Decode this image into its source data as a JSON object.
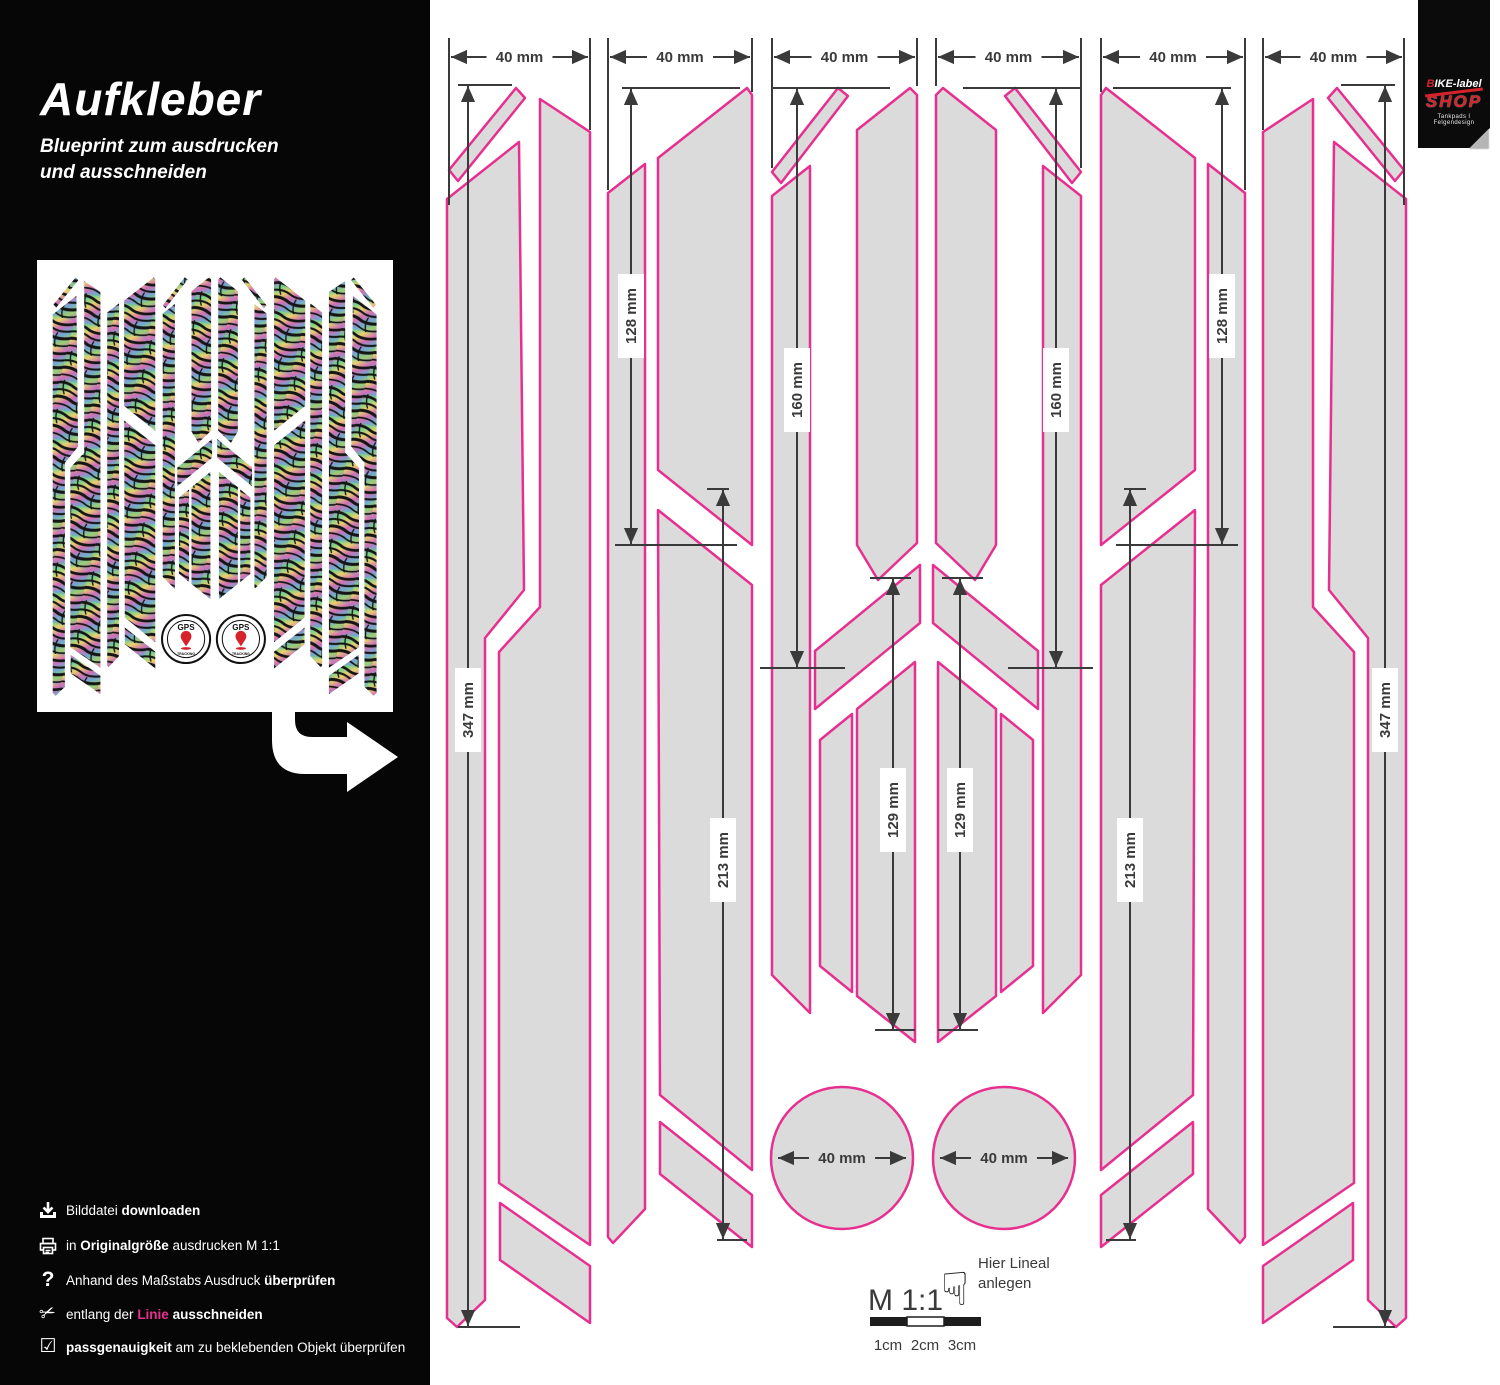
{
  "sidebar": {
    "title": "Aufkleber",
    "subtitle_line1": "Blueprint zum ausdrucken",
    "subtitle_line2": "und ausschneiden",
    "instructions": [
      {
        "icon": "download-icon",
        "parts": [
          {
            "t": "Bilddatei "
          },
          {
            "t": "downloaden",
            "b": true
          }
        ]
      },
      {
        "icon": "printer-icon",
        "parts": [
          {
            "t": "in "
          },
          {
            "t": "Originalgröße",
            "b": true
          },
          {
            "t": " ausdrucken M 1:1"
          }
        ]
      },
      {
        "icon": "question-icon",
        "parts": [
          {
            "t": "Anhand des Maßstabs Ausdruck "
          },
          {
            "t": "überprüfen",
            "b": true
          }
        ]
      },
      {
        "icon": "scissors-icon",
        "parts": [
          {
            "t": "entlang der "
          },
          {
            "t": "Linie",
            "pink": true
          },
          {
            "t": " "
          },
          {
            "t": "ausschneiden",
            "b": true
          }
        ]
      },
      {
        "icon": "checkbox-icon",
        "parts": [
          {
            "t": "passgenauigkeit",
            "b": true
          },
          {
            "t": " am zu beklebenden Objekt überprüfen"
          }
        ]
      }
    ]
  },
  "logo": {
    "brand": "BIKE-label",
    "shop": "SHOP",
    "tagline": "Tankpads I Felgendesign"
  },
  "preview": {
    "gps_label": "GPS",
    "tracking_label": "TRACKING"
  },
  "colors": {
    "cut_line": "#e72f90",
    "shape_fill": "#dbdbdb",
    "dim": "#3a3a3a",
    "accent_red": "#d6232b",
    "ruler_dark": "#1d1d1d"
  },
  "blueprint": {
    "mirror_axis": 1853,
    "shapes": [
      {
        "name": "c1-top-sliver",
        "points": "449,170 516,88 525,98 458,181"
      },
      {
        "name": "c1-strip-narrow",
        "points": "447,199 519,142 524,590 485,638 485,1300 457,1327 447,1318"
      },
      {
        "name": "c1-strip-wide",
        "points": "540,99 590,132 590,1245 499,1183 499,652 540,607"
      },
      {
        "name": "c1-bottom-band",
        "points": "500,1203 590,1266 590,1323 500,1260"
      },
      {
        "name": "c2-strip-narrow",
        "points": "608,193 645,164 645,1209 613,1243 608,1237"
      },
      {
        "name": "c2-strip-upper",
        "points": "658,158 747,88 752,95 752,545 658,470"
      },
      {
        "name": "c2-strip-lower",
        "points": "658,510 752,585 752,1170 660,1095"
      },
      {
        "name": "c2-bottom-band",
        "points": "660,1122 752,1195 752,1247 660,1174"
      },
      {
        "name": "c3-top-sliver",
        "points": "772,172 838,88 848,96 781,183"
      },
      {
        "name": "c3-strip-narrow",
        "points": "772,196 810,166 810,1013 772,975"
      },
      {
        "name": "c3-strip-upper-wide",
        "points": "857,130 910,88 917,95 917,543 878,580 857,545"
      },
      {
        "name": "c3-chevron-band",
        "points": "920,565 920,623 815,709 815,651"
      },
      {
        "name": "c3-strip-lower-narrow",
        "points": "820,740 852,714 852,992 820,966"
      },
      {
        "name": "c3-strip-lower-wide",
        "points": "857,709 915,662 915,1042 857,996"
      }
    ],
    "circles": [
      {
        "cx": 842,
        "cy": 1158,
        "r": 71,
        "label": "40 mm"
      },
      {
        "cx": 1004,
        "cy": 1158,
        "r": 71,
        "label": "40 mm"
      }
    ],
    "top_dims": [
      {
        "x1": 449,
        "x2": 590,
        "e1": 205,
        "e2": 130,
        "label": "40 mm"
      },
      {
        "x1": 608,
        "x2": 752,
        "e1": 190,
        "e2": 92,
        "label": "40 mm"
      },
      {
        "x1": 772,
        "x2": 917,
        "e1": 168,
        "e2": 86,
        "label": "40 mm"
      },
      {
        "x1": 936,
        "x2": 1081,
        "e1": 86,
        "e2": 168,
        "label": "40 mm"
      },
      {
        "x1": 1101,
        "x2": 1245,
        "e1": 92,
        "e2": 190,
        "label": "40 mm"
      },
      {
        "x1": 1263,
        "x2": 1404,
        "e1": 130,
        "e2": 205,
        "label": "40 mm"
      }
    ],
    "v_dims": [
      {
        "x": 468,
        "y1": 85,
        "y2": 1327,
        "t1": [
          -10,
          44
        ],
        "t2": [
          -10,
          52
        ],
        "label": "347 mm",
        "label_y": 710,
        "mirror": true
      },
      {
        "x": 631,
        "y1": 88,
        "y2": 545,
        "t1": [
          -9,
          109
        ],
        "t2": [
          -16,
          106
        ],
        "label": "128 mm",
        "label_y": 316,
        "mirror": true
      },
      {
        "x": 797,
        "y1": 88,
        "y2": 668,
        "t1": [
          -25,
          93
        ],
        "t2": [
          -37,
          48
        ],
        "label": "160 mm",
        "label_y": 390,
        "mirror": true
      },
      {
        "x": 723,
        "y1": 489,
        "y2": 1240,
        "t1": [
          -16,
          6
        ],
        "t2": [
          -6,
          24
        ],
        "label": "213 mm",
        "label_y": 860,
        "mirror": true
      },
      {
        "x": 893,
        "y1": 578,
        "y2": 1030,
        "t1": [
          -23,
          18
        ],
        "t2": [
          -18,
          22
        ],
        "label": "129 mm",
        "label_y": 810,
        "mirror": true
      }
    ],
    "scale": {
      "m_label": "M 1:1",
      "hint_line1": "Hier Lineal",
      "hint_line2": "anlegen",
      "hand_icon": "pointing-hand",
      "ruler_labels": [
        "1cm",
        "2cm",
        "3cm"
      ]
    }
  }
}
